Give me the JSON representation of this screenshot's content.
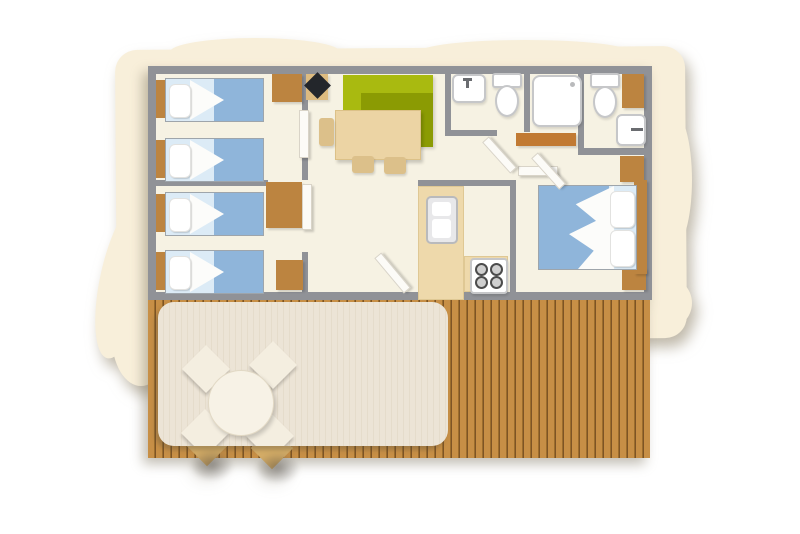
{
  "image": {
    "kind": "floor-plan-illustration",
    "text_content": "none",
    "width_px": 800,
    "height_px": 534
  },
  "colors": {
    "wall": "#909297",
    "floor": "#f6f2e3",
    "paper": "#f8efda",
    "wood": "#bc8440",
    "wood-light": "#ddbb80",
    "bench": "#c17a33",
    "deck-a": "#c78f46",
    "deck-b": "#9c6d2c",
    "deck-c": "#7d5426",
    "awning": "#ece4d6",
    "awning-line": "#e5dccb",
    "blanket": "#8fb5da",
    "sheet": "#dcebf6",
    "sofa": "#a9ba10",
    "sofa-dark": "#8b9b03",
    "counter": "#eed9ab",
    "table": "#ecd4a4",
    "chair": "#dcc08a",
    "fixture": "#ffffff",
    "fixture-border": "#c6c7c9",
    "tv": "#23262b",
    "patio-chair": "#f4eee0",
    "patio-table": "#f7f2e6"
  },
  "plan": {
    "unit": {
      "rooms": [
        {
          "name": "kids-bedroom-front",
          "furniture": [
            "single-bed",
            "single-bed",
            "wardrobe"
          ]
        },
        {
          "name": "kids-bedroom-back",
          "furniture": [
            "single-bed",
            "single-bed",
            "wardrobe",
            "cabinet"
          ]
        },
        {
          "name": "living-dining",
          "furniture": [
            "corner-sofa",
            "dining-table",
            "chair",
            "chair",
            "chair",
            "tv",
            "tv-stand"
          ]
        },
        {
          "name": "kitchen",
          "furniture": [
            "l-shaped-counter",
            "fridge",
            "hob-4-burners"
          ]
        },
        {
          "name": "bathroom",
          "furniture": [
            "washbasin",
            "toilet",
            "shower",
            "bench"
          ]
        },
        {
          "name": "wc",
          "furniture": [
            "toilet",
            "washbasin",
            "cabinet"
          ]
        },
        {
          "name": "master-bedroom",
          "furniture": [
            "double-bed",
            "wardrobe",
            "wardrobe",
            "shelf"
          ]
        }
      ],
      "single_beds": 4,
      "double_beds": 1,
      "door_leaves": 6
    },
    "terrace": {
      "name": "terrace",
      "furniture": [
        "wood-decking",
        "awning-canopy",
        "round-table",
        "patio-chair",
        "patio-chair",
        "patio-chair",
        "patio-chair"
      ]
    }
  }
}
